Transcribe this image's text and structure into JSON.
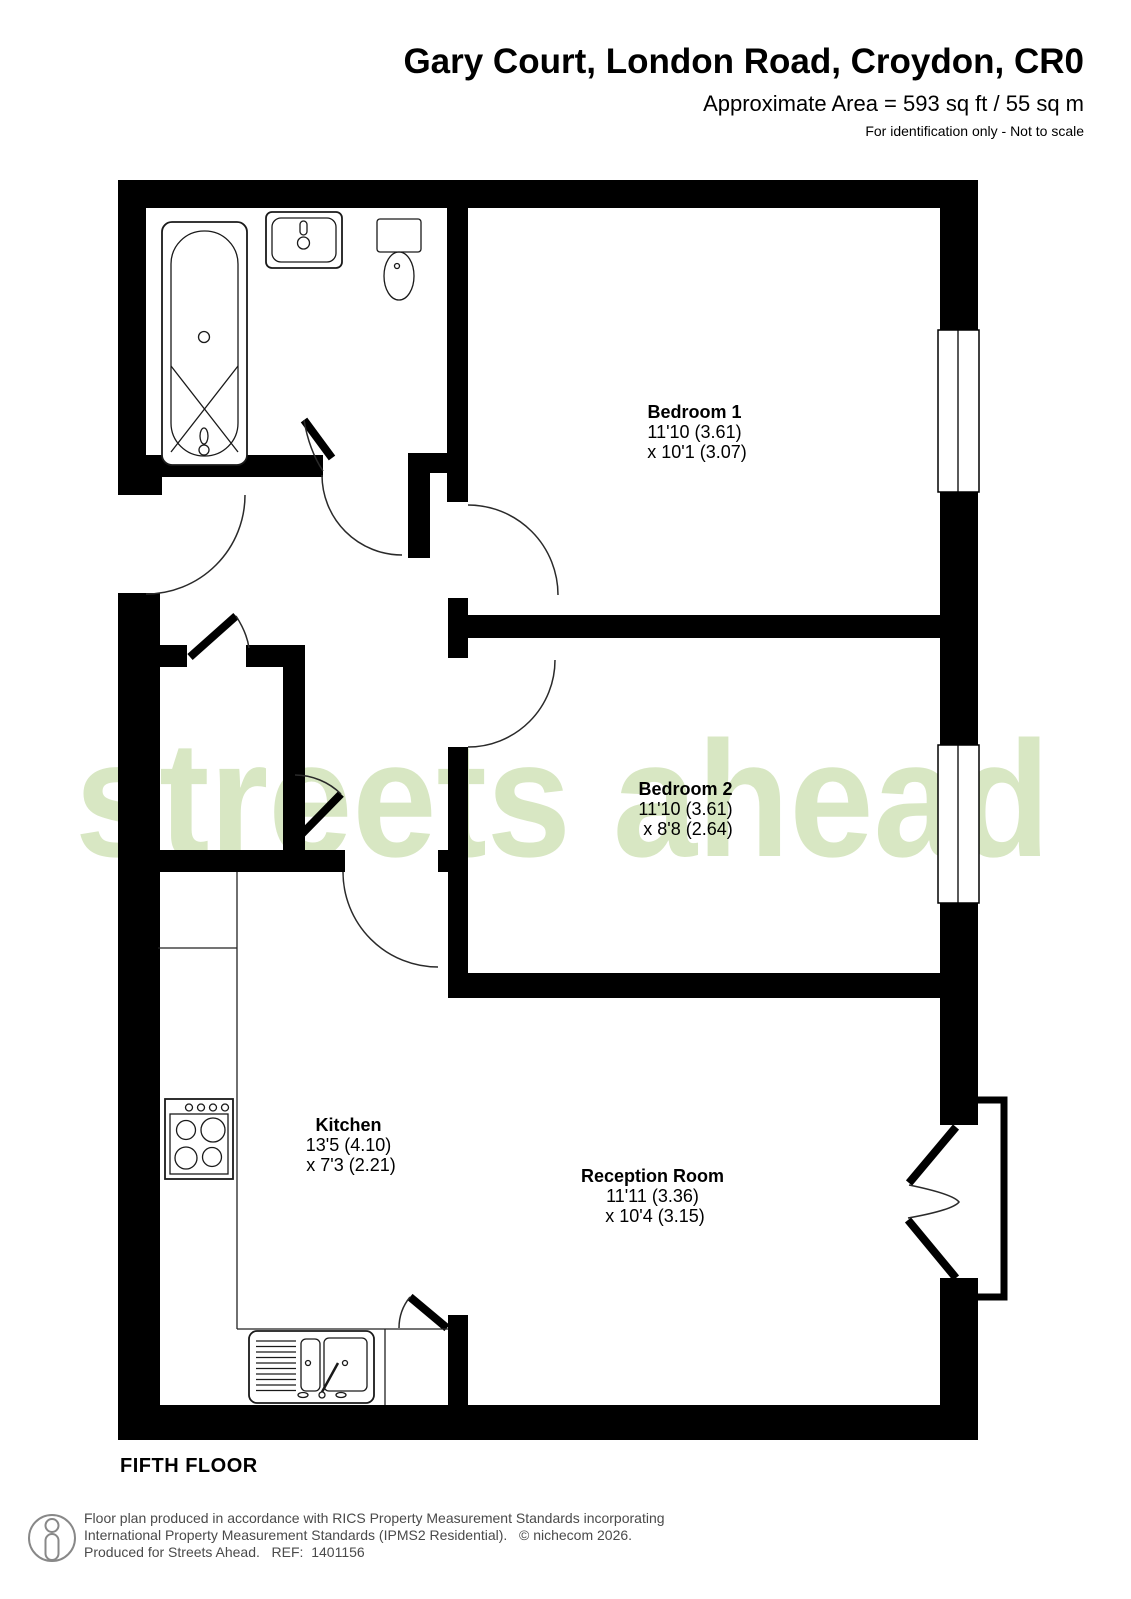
{
  "header": {
    "title": "Gary Court, London Road, Croydon, CR0",
    "area": "Approximate Area = 593 sq ft / 55 sq m",
    "disclaimer": "For identification only - Not to scale"
  },
  "watermark": {
    "text": "streets ahead"
  },
  "rooms": {
    "bedroom1": {
      "name": "Bedroom 1",
      "line1": "11'10 (3.61)",
      "line2": "x 10'1 (3.07)"
    },
    "bedroom2": {
      "name": "Bedroom 2",
      "line1": "11'10 (3.61)",
      "line2": "x 8'8 (2.64)"
    },
    "kitchen": {
      "name": "Kitchen",
      "line1": "13'5 (4.10)",
      "line2": "x 7'3 (2.21)"
    },
    "reception": {
      "name": "Reception Room",
      "line1": "11'11 (3.36)",
      "line2": "x 10'4 (3.15)"
    }
  },
  "floor_label": "FIFTH FLOOR",
  "footer": {
    "line1": "Floor plan produced in accordance with RICS Property Measurement Standards incorporating",
    "line2": "International Property Measurement Standards (IPMS2 Residential).   © nichecom 2026.",
    "line3": "Produced for Streets Ahead.   REF:  1401156"
  },
  "colors": {
    "wall": "#000000",
    "watermark": "#d8e7c3",
    "footer_text": "#4a4a4a"
  }
}
